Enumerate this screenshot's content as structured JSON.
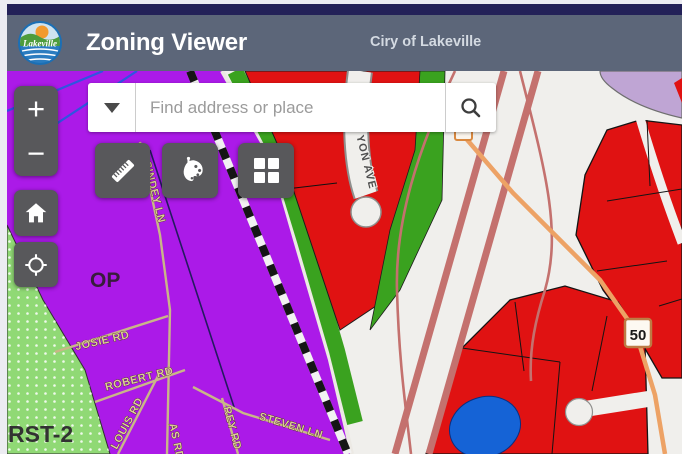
{
  "header": {
    "title": "Zoning Viewer",
    "subtitle": "Ciry of Lakeville",
    "logo_text": "Lakeville"
  },
  "search": {
    "placeholder": "Find address or place"
  },
  "controls": {
    "zoom_in": "+",
    "zoom_out": "−"
  },
  "icons": {
    "toolbar": [
      "measure-ruler-icon",
      "draw-palette-icon",
      "basemap-grid-icon"
    ],
    "left_panel": [
      "zoom-in-icon",
      "zoom-out-icon",
      "home-icon",
      "locate-crosshair-icon"
    ],
    "search": [
      "dropdown-caret-icon",
      "magnifier-icon"
    ]
  },
  "map": {
    "zone_labels": {
      "op": "OP",
      "rst2": "RST-2"
    },
    "street_labels": {
      "sindey": "SINDEY LN",
      "josie": "JOSIE RD",
      "robert": "ROBERT RD",
      "louis": "LOUIS RD",
      "as_rd": "AS RD",
      "rey": "REY RD",
      "steven": "STEVEN LN",
      "yon": "YON AVE"
    },
    "highway_shield": "50",
    "colors": {
      "zone_purple": "#ab1ae8",
      "zone_red": "#e01212",
      "zone_green_bright": "#3aa21f",
      "zone_green_light": "#90d975",
      "zone_lavender": "#bfa5d4",
      "zone_blue": "#1563d6",
      "road_dusty_red": "#c4716e",
      "road_orange": "#eda265",
      "street_tan": "#c9b687",
      "header_bar": "#5c6679",
      "navy_strip": "#232158",
      "button_gray": "#58585b"
    }
  }
}
